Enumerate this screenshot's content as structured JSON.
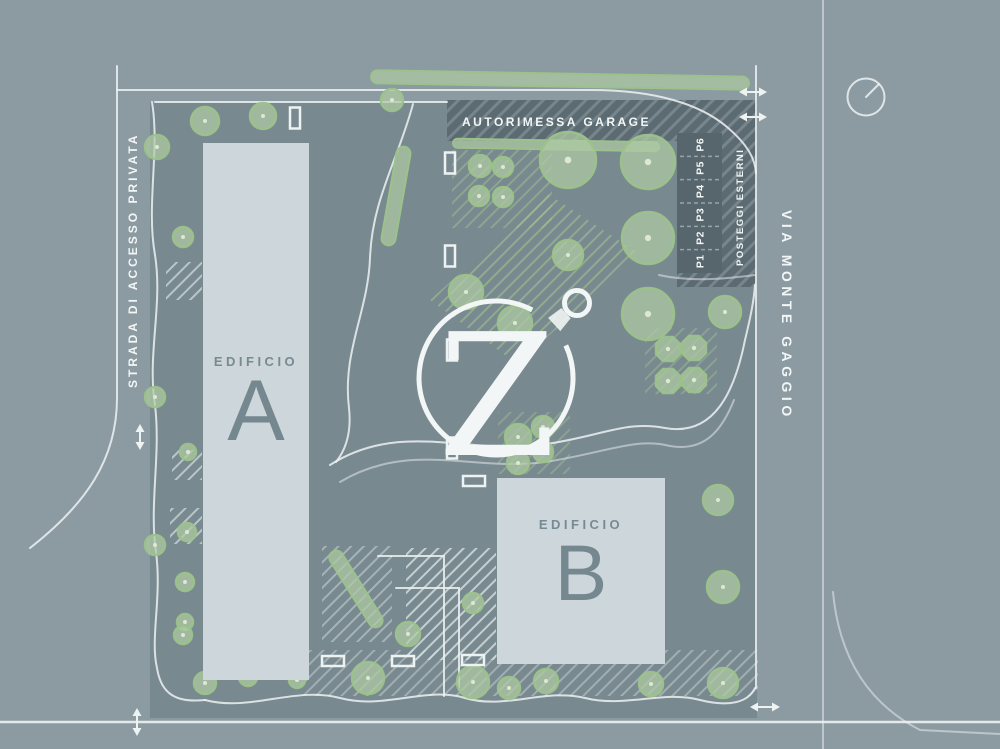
{
  "canvas": {
    "width": 1000,
    "height": 749
  },
  "palette": {
    "outer_bg": "#8C9BA2",
    "site_bg": "#798990",
    "line_white": "#EDF2F2",
    "building_fill": "#CDD6DA",
    "building_text": "#778A93",
    "tree_fill": "#AECBA3",
    "tree_stroke": "#9CC28B",
    "tree_dot": "#DCE8D2",
    "band_fill": "#5C6B72",
    "band_hatch": "#7A8990",
    "hatch_green": "#9FC18F",
    "hatch_white": "#DCE6E6",
    "text_white": "#F2F6F6"
  },
  "labels": {
    "street_left": "STRADA DI ACCESSO PRIVATA",
    "street_right": "VIA MONTE GAGGIO",
    "garage_band": "AUTORIMESSA GARAGE",
    "parking_zone": "POSTEGGI ESTERNI",
    "building_a_title": "EDIFICIO",
    "building_a_letter": "A",
    "building_b_title": "EDIFICIO",
    "building_b_letter": "B",
    "logo_letter": "Z",
    "stalls": [
      "P1",
      "P2",
      "P3",
      "P4",
      "P5",
      "P6"
    ]
  },
  "map_elements": {
    "trees": [
      [
        205,
        121,
        14
      ],
      [
        263,
        116,
        13
      ],
      [
        392,
        100,
        11
      ],
      [
        157,
        147,
        12
      ],
      [
        183,
        237,
        10
      ],
      [
        480,
        166,
        11
      ],
      [
        503,
        167,
        10
      ],
      [
        479,
        196,
        10
      ],
      [
        503,
        197,
        10
      ],
      [
        568,
        160,
        28
      ],
      [
        648,
        162,
        27
      ],
      [
        648,
        238,
        26
      ],
      [
        648,
        314,
        26
      ],
      [
        568,
        255,
        15
      ],
      [
        515,
        323,
        17
      ],
      [
        466,
        292,
        17
      ],
      [
        518,
        437,
        13
      ],
      [
        543,
        427,
        11
      ],
      [
        518,
        463,
        11
      ],
      [
        543,
        452,
        10
      ],
      [
        725,
        312,
        16
      ],
      [
        718,
        500,
        15
      ],
      [
        723,
        587,
        16
      ],
      [
        155,
        397,
        10
      ],
      [
        188,
        452,
        8
      ],
      [
        187,
        532,
        9
      ],
      [
        155,
        545,
        10
      ],
      [
        185,
        582,
        9
      ],
      [
        185,
        622,
        8
      ],
      [
        183,
        635,
        9
      ],
      [
        205,
        683,
        11
      ],
      [
        248,
        677,
        9
      ],
      [
        297,
        680,
        8
      ],
      [
        368,
        678,
        16
      ],
      [
        408,
        634,
        12
      ],
      [
        473,
        603,
        10
      ],
      [
        473,
        682,
        16
      ],
      [
        509,
        688,
        11
      ],
      [
        546,
        681,
        12
      ],
      [
        651,
        684,
        12
      ],
      [
        723,
        683,
        15
      ]
    ],
    "shrubs": [
      [
        668,
        349,
        13
      ],
      [
        694,
        348,
        13
      ],
      [
        668,
        381,
        13
      ],
      [
        694,
        380,
        13
      ]
    ],
    "hedges": [
      {
        "cx": 560,
        "cy": 80,
        "len": 378,
        "w": 13,
        "angle": 1
      },
      {
        "cx": 556,
        "cy": 145,
        "len": 206,
        "w": 9,
        "angle": 1
      },
      {
        "cx": 396,
        "cy": 196,
        "len": 100,
        "w": 14,
        "angle": 100
      },
      {
        "cx": 356,
        "cy": 589,
        "len": 88,
        "w": 14,
        "angle": 58
      }
    ],
    "benches": [
      {
        "x": 295,
        "y": 118,
        "w": 10,
        "h": 21
      },
      {
        "x": 450,
        "y": 163,
        "w": 10,
        "h": 21
      },
      {
        "x": 450,
        "y": 256,
        "w": 10,
        "h": 21
      },
      {
        "x": 452,
        "y": 350,
        "w": 10,
        "h": 21
      },
      {
        "x": 452,
        "y": 448,
        "w": 10,
        "h": 21
      },
      {
        "x": 474,
        "y": 481,
        "w": 22,
        "h": 10
      },
      {
        "x": 333,
        "y": 661,
        "w": 22,
        "h": 10
      },
      {
        "x": 403,
        "y": 661,
        "w": 22,
        "h": 10
      },
      {
        "x": 473,
        "y": 660,
        "w": 22,
        "h": 10
      }
    ],
    "arrows": [
      {
        "x": 753,
        "y": 92,
        "len": 28,
        "dir": "h"
      },
      {
        "x": 753,
        "y": 117,
        "len": 28,
        "dir": "h"
      },
      {
        "x": 140,
        "y": 437,
        "len": 26,
        "dir": "v"
      },
      {
        "x": 137,
        "y": 722,
        "len": 28,
        "dir": "v"
      },
      {
        "x": 765,
        "y": 707,
        "len": 30,
        "dir": "h"
      }
    ],
    "parking": {
      "x": 677,
      "y": 133,
      "w": 45,
      "h": 140,
      "count": 6
    }
  }
}
